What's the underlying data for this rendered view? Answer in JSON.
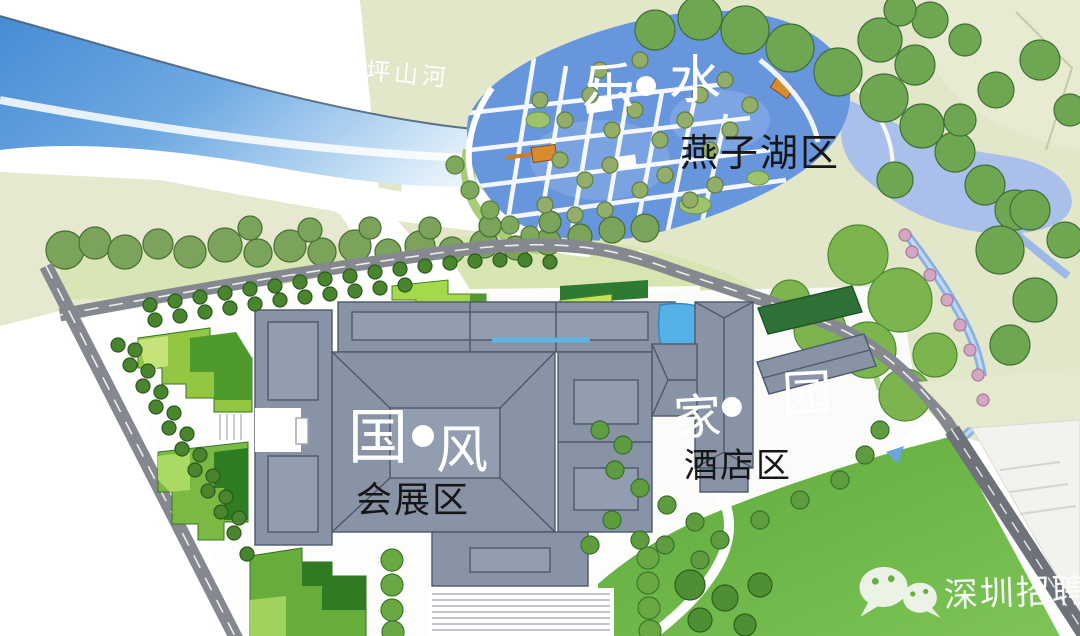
{
  "page": {
    "type": "landscape-masterplan-map"
  },
  "labels": {
    "river": "坪山河",
    "lake": {
      "theme_a": "乐",
      "theme_b": "水",
      "zone": "燕子湖区"
    },
    "expo": {
      "theme_a": "国",
      "theme_b": "风",
      "zone": "会展区"
    },
    "hotel": {
      "theme_a": "家",
      "theme_b": "园",
      "zone": "酒店区"
    }
  },
  "watermark": {
    "icon": "wechat-icon",
    "text": "深圳招聘会"
  },
  "colors": {
    "river_blue": "#4d92d6",
    "lake_blue": "#6796dd",
    "pond_blue": "#aabfe9",
    "pool_blue": "#54b0e7",
    "park_pale": "#e2e7c9",
    "park_green": "#9ccb56",
    "tree_olive": "#7ca35b",
    "lawn_green": "#6bb244",
    "road_gray": "#85898f",
    "road_dark": "#6d7379",
    "roof_gray": "#8893a5",
    "roof_outline": "#4f5a6e",
    "pier_orange": "#d98a2e",
    "blossom_pink": "#d3a6c4",
    "label_white": "#ffffff",
    "label_black": "#161616"
  }
}
